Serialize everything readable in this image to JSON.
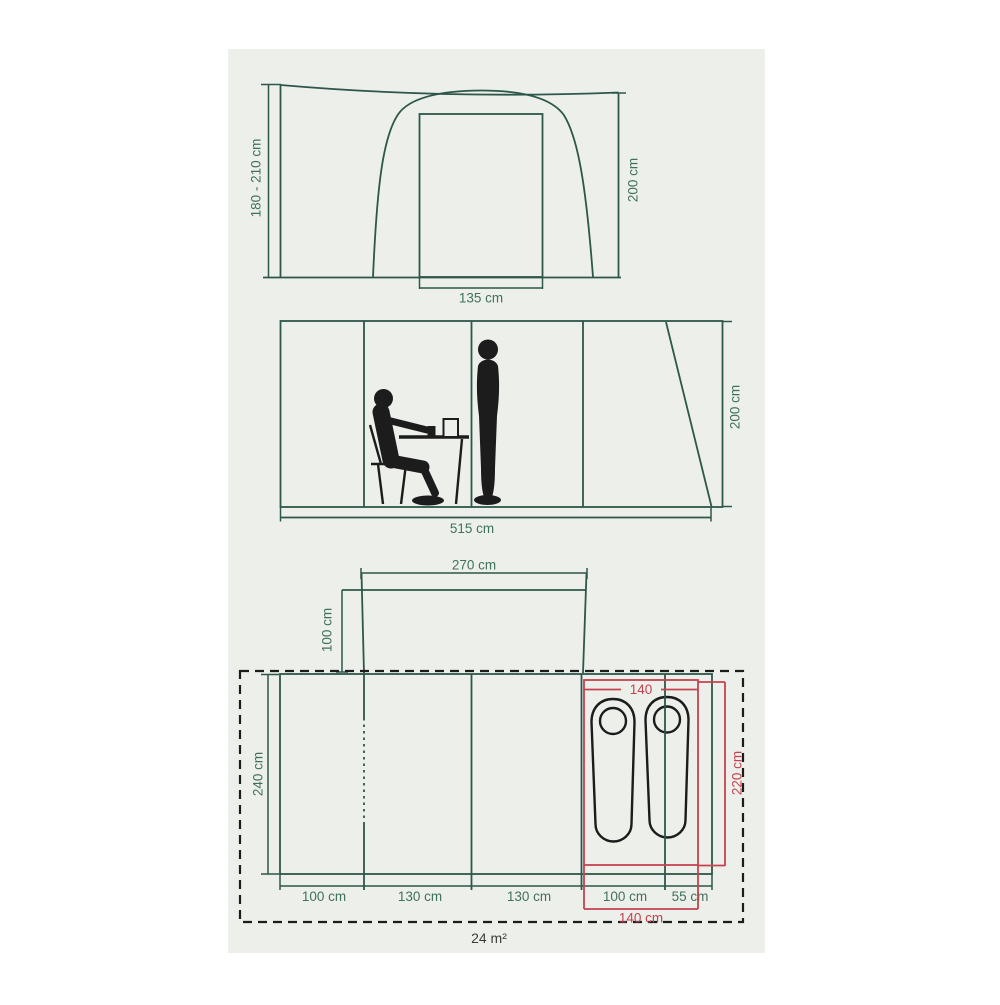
{
  "colors": {
    "page_bg": "#ffffff",
    "panel_bg": "#edefeb",
    "green_line": "#2d574a",
    "green_text": "#3f725c",
    "red": "#c5424e",
    "black": "#1c1c1c",
    "text_dark": "#3a3f3c"
  },
  "front_view": {
    "height_range_label": "180 - 210 cm",
    "height_label": "200 cm",
    "door_width_label": "135 cm"
  },
  "side_view": {
    "length_label": "515 cm",
    "height_label": "200 cm"
  },
  "floor_plan": {
    "porch_width_label": "270 cm",
    "porch_depth_label": "100 cm",
    "depth_label": "240 cm",
    "sleeping_width_label": "140",
    "sleeping_depth_label": "220 cm",
    "sleeping_width_bottom_label": "140 cm",
    "segment_labels": [
      "100 cm",
      "130 cm",
      "130 cm",
      "100 cm",
      "55 cm"
    ],
    "area_label": "24 m²"
  }
}
